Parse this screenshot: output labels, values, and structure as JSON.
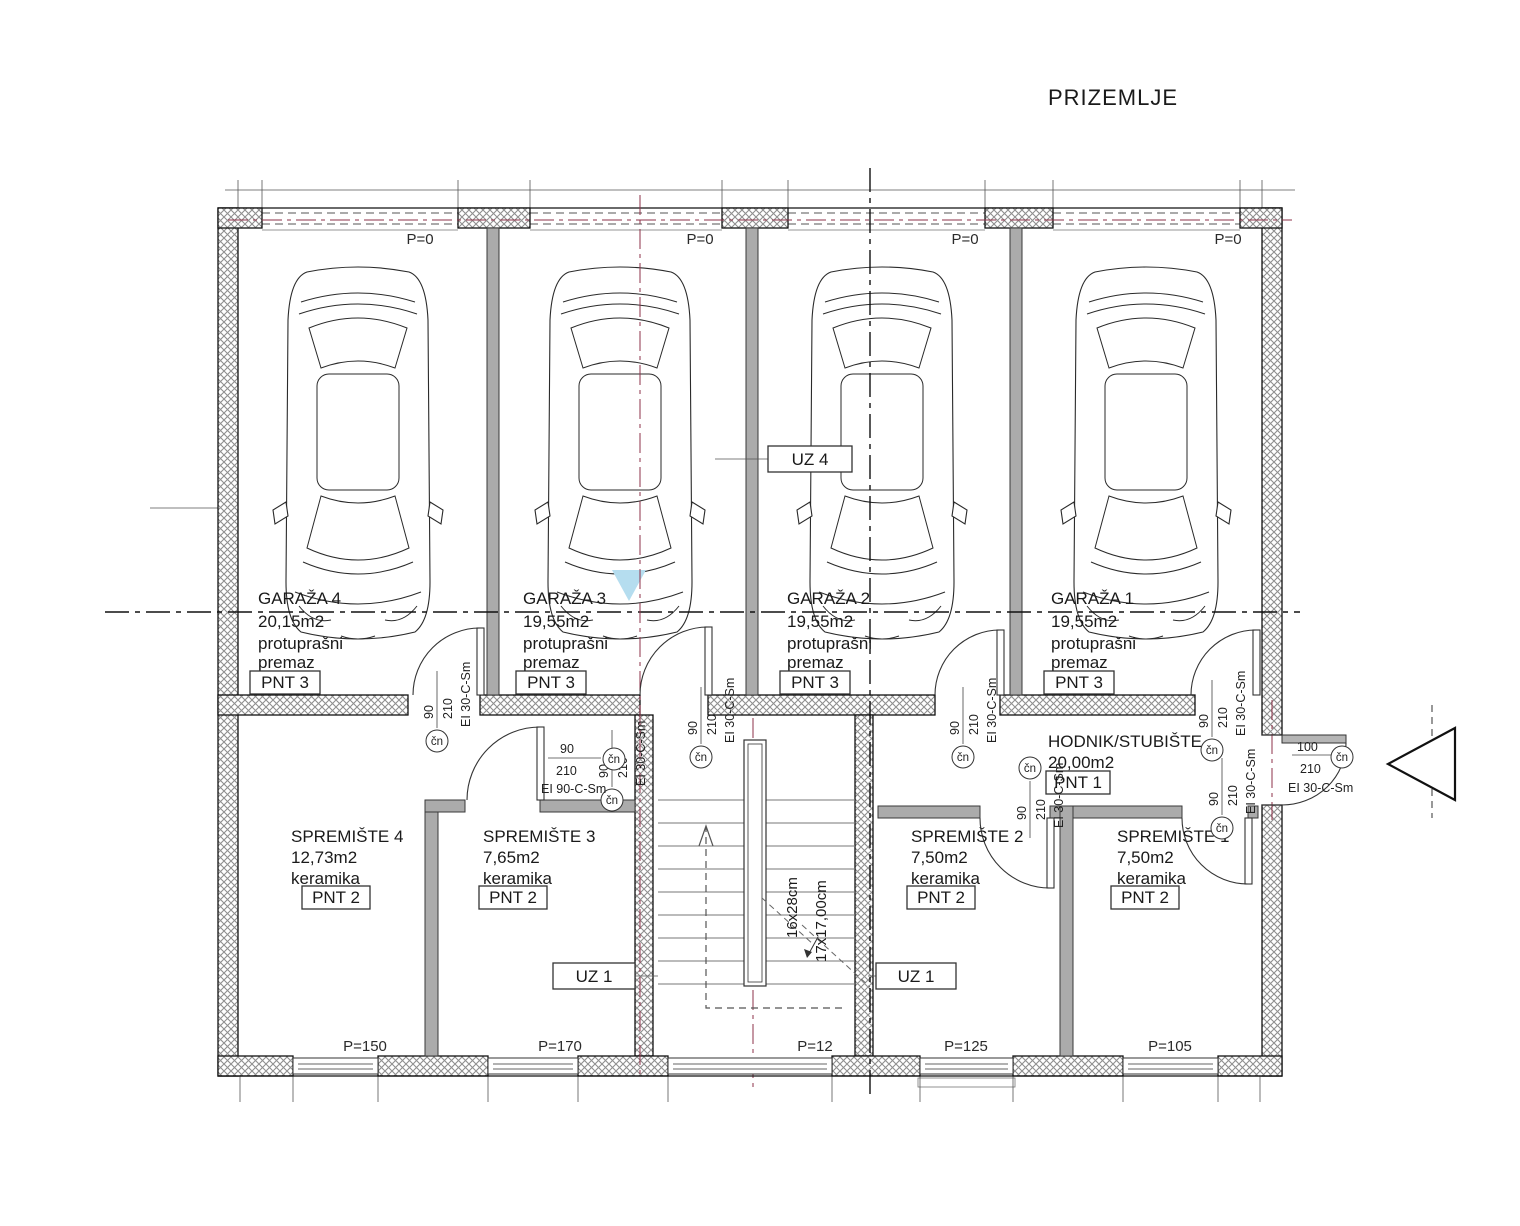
{
  "title": "PRIZEMLJE",
  "colors": {
    "axis_red": "#8e3148",
    "watermark_blue": "#b5ddef",
    "wall_gray": "#ababab"
  },
  "rooms": {
    "garaza4": {
      "name": "GARAŽA 4",
      "area": "20,15m2",
      "finish_line1": "protuprašni",
      "finish_line2": "premaz",
      "pnt": "PNT 3"
    },
    "garaza3": {
      "name": "GARAŽA 3",
      "area": "19,55m2",
      "finish_line1": "protuprašni",
      "finish_line2": "premaz",
      "pnt": "PNT 3"
    },
    "garaza2": {
      "name": "GARAŽA 2",
      "area": "19,55m2",
      "finish_line1": "protuprašni",
      "finish_line2": "premaz",
      "pnt": "PNT 3"
    },
    "garaza1": {
      "name": "GARAŽA 1",
      "area": "19,55m2",
      "finish_line1": "protuprašni",
      "finish_line2": "premaz",
      "pnt": "PNT 3"
    },
    "hodnik": {
      "name": "HODNIK/STUBIŠTE",
      "area": "20,00m2",
      "pnt": "PNT 1"
    },
    "spremiste4": {
      "name": "SPREMIŠTE 4",
      "area": "12,73m2",
      "finish": "keramika",
      "pnt": "PNT 2"
    },
    "spremiste3": {
      "name": "SPREMIŠTE 3",
      "area": "7,65m2",
      "finish": "keramika",
      "pnt": "PNT 2"
    },
    "spremiste2": {
      "name": "SPREMIŠTE 2",
      "area": "7,50m2",
      "finish": "keramika",
      "pnt": "PNT 2"
    },
    "spremiste1": {
      "name": "SPREMIŠTE 1",
      "area": "7,50m2",
      "finish": "keramika",
      "pnt": "PNT 2"
    }
  },
  "zone_labels": {
    "uz4": "UZ 4",
    "uz1_left": "UZ 1",
    "uz1_right": "UZ 1"
  },
  "levels": {
    "top": [
      "P=0",
      "P=0",
      "P=0",
      "P=0"
    ],
    "bottom": [
      "P=150",
      "P=170",
      "P=12",
      "P=125",
      "P=105"
    ]
  },
  "stairs": {
    "dim_tread": "16x28cm",
    "dim_riser": "17x17,00cm"
  },
  "doors": {
    "garage4": {
      "marker": "čn",
      "width": "90",
      "height": "210",
      "rating": "EI 30-C-Sm"
    },
    "garage3": {
      "marker": "čn",
      "width": "90",
      "height": "210",
      "rating": "EI 30-C-Sm"
    },
    "garage2": {
      "marker": "čn",
      "width": "90",
      "height": "210",
      "rating": "EI 30-C-Sm"
    },
    "garage1": {
      "marker": "čn",
      "width": "90",
      "height": "210",
      "rating": "EI 30-C-Sm"
    },
    "stairs": {
      "marker": "čn",
      "width": "90",
      "height": "210",
      "rating": "EI 30-C-Sm"
    },
    "spremiste3": {
      "marker": "čn",
      "width": "90",
      "height": "210",
      "rating": "EI 90-C-Sm"
    },
    "spremiste2": {
      "marker": "čn",
      "width": "90",
      "height": "210",
      "rating": "EI 30-C-Sm"
    },
    "spremiste1": {
      "marker": "čn",
      "width": "90",
      "height": "210",
      "rating": "EI 30-C-Sm"
    },
    "entrance": {
      "marker": "čn",
      "width": "100",
      "height": "210",
      "rating": "EI 30-C-Sm"
    }
  }
}
